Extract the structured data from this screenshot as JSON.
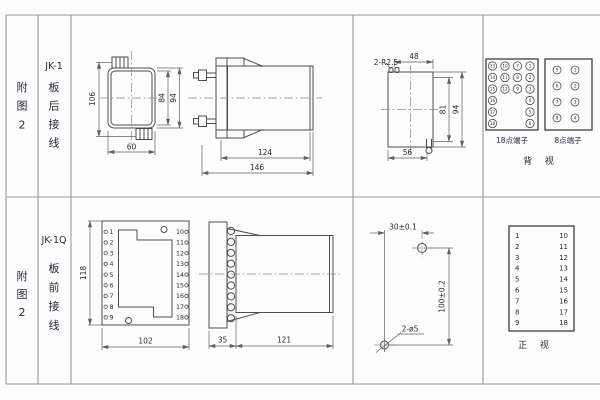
{
  "row1": {
    "fig_label": [
      "附",
      "图",
      "2"
    ],
    "model": "JK-1",
    "wiring": [
      "板",
      "后",
      "接",
      "线"
    ],
    "rear_view": {
      "dim_height": "106",
      "dim_inner": "84",
      "dim_outer": "94",
      "dim_width": "60"
    },
    "side_view": {
      "dim_body": "124",
      "dim_total": "146"
    },
    "cutout": {
      "radius": "2-R2.5",
      "dim_top": "48",
      "dim_inner_h": "81",
      "dim_h": "94",
      "dim_w": "56"
    },
    "terminals": {
      "t18_label": "18点端子",
      "t18_rows": [
        [
          "13",
          "10",
          "7",
          "1"
        ],
        [
          "14",
          "11",
          "8",
          "2"
        ],
        [
          "15",
          "12",
          "9",
          "3"
        ]
      ],
      "t18_side": [
        [
          "16",
          "4"
        ],
        [
          "17",
          "5"
        ],
        [
          "18",
          "6"
        ]
      ],
      "t8_label": "8点端子",
      "t8_rows": [
        [
          "5",
          "1"
        ],
        [
          "6",
          "2"
        ],
        [
          "7",
          "3"
        ],
        [
          "8",
          "4"
        ]
      ],
      "view_label": "背 视"
    }
  },
  "row2": {
    "fig_label": [
      "附",
      "图",
      "2"
    ],
    "model": "JK-1Q",
    "wiring": [
      "板",
      "前",
      "接",
      "线"
    ],
    "front_view": {
      "left": [
        "1",
        "2",
        "3",
        "4",
        "5",
        "6",
        "7",
        "8",
        "9"
      ],
      "right": [
        "10",
        "11",
        "12",
        "13",
        "14",
        "15",
        "16",
        "17",
        "18"
      ],
      "dim_h": "118",
      "dim_w": "102"
    },
    "side_view": {
      "dim_flange": "35",
      "dim_body": "121"
    },
    "drill": {
      "dim_x": "30±0.1",
      "dim_y": "100±0.2",
      "holes": "2-ø5"
    },
    "front_table": {
      "left": [
        "1",
        "2",
        "3",
        "4",
        "5",
        "6",
        "7",
        "8",
        "9"
      ],
      "right": [
        "10",
        "11",
        "12",
        "13",
        "14",
        "15",
        "16",
        "17",
        "18"
      ],
      "view_label": "正 视"
    }
  }
}
